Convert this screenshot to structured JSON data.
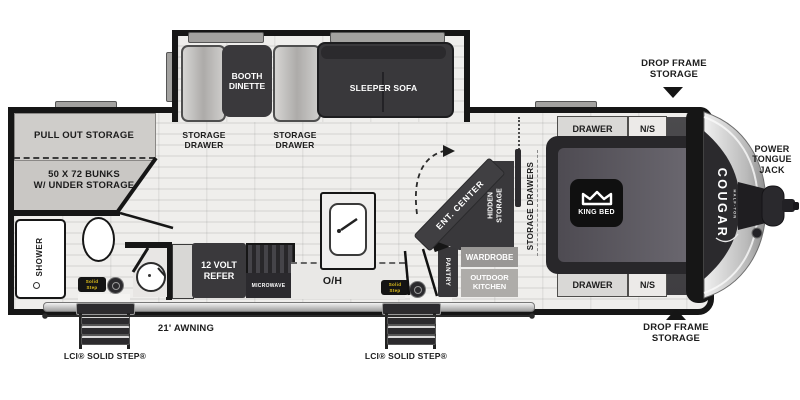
{
  "colors": {
    "wall": "#161616",
    "floor": "#e8e7e5",
    "dark_furniture": "#3a393c",
    "light_furniture": "#c9c7c4",
    "silver": "#c9c9c9",
    "badge_yellow": "#e5c41c"
  },
  "branding": {
    "logo": "COUGAR",
    "logo_sub": "HALF-TON"
  },
  "annotations": {
    "drop_frame_top": {
      "line1": "DROP FRAME",
      "line2": "STORAGE"
    },
    "drop_frame_bottom": {
      "line1": "DROP FRAME",
      "line2": "STORAGE"
    },
    "power_tongue_jack": {
      "line1": "POWER",
      "line2": "TONGUE",
      "line3": "JACK"
    },
    "awning": "21' AWNING",
    "solid_step_left": "LCI® SOLID STEP®",
    "solid_step_right": "LCI® SOLID STEP®"
  },
  "rear": {
    "pull_out_storage": "PULL OUT STORAGE",
    "bunks": {
      "line1": "50 X 72 BUNKS",
      "line2": "W/ UNDER STORAGE"
    },
    "shower": "SHOWER"
  },
  "slide": {
    "booth_dinette": {
      "line1": "BOOTH",
      "line2": "DINETTE"
    },
    "sleeper_sofa": "SLEEPER SOFA",
    "storage_drawer_left": {
      "line1": "STORAGE",
      "line2": "DRAWER"
    },
    "storage_drawer_right": {
      "line1": "STORAGE",
      "line2": "DRAWER"
    }
  },
  "kitchen": {
    "refer": {
      "line1": "12 VOLT",
      "line2": "REFER"
    },
    "microwave": "MICROWAVE",
    "overhead": "O/H",
    "pantry": "PANTRY",
    "badge": {
      "line1": "Solid",
      "line2": "Step"
    }
  },
  "mid": {
    "ent_center": "ENT. CENTER",
    "hidden_storage": {
      "line1": "HIDDEN",
      "line2": "STORAGE"
    },
    "wardrobe": "WARDROBE",
    "outdoor_kitchen": {
      "line1": "OUTDOOR",
      "line2": "KITCHEN"
    }
  },
  "bedroom": {
    "storage_drawers": "STORAGE DRAWERS",
    "king_bed": "KING BED",
    "drawer_top": "DRAWER",
    "ns_top": "N/S",
    "drawer_bottom": "DRAWER",
    "ns_bottom": "N/S"
  }
}
